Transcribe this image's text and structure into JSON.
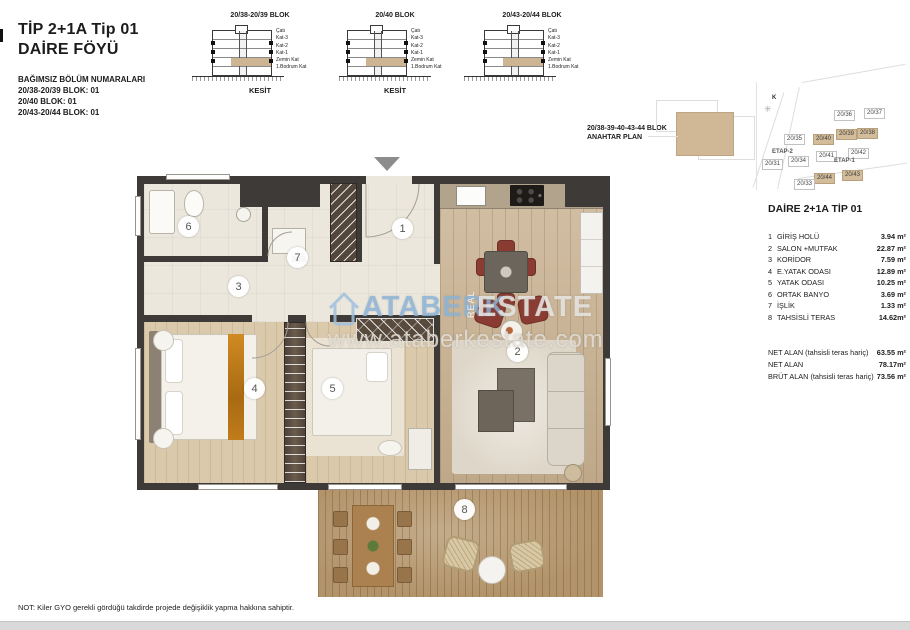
{
  "header": {
    "title_line1": "TİP 2+1A Tip 01",
    "title_line2": "DAİRE FÖYÜ",
    "subtitle": "BAĞIMSIZ BÖLÜM NUMARALARI",
    "block_lines": {
      "0": "20/38-20/39 BLOK: 01",
      "1": "20/40 BLOK: 01",
      "2": "20/43-20/44 BLOK: 01"
    }
  },
  "sections": {
    "floor_labels": {
      "0": "Çatı",
      "1": "Kat-3",
      "2": "Kat-2",
      "3": "Kat-1",
      "4": "Zemin Kat",
      "5": "1.Bodrum Kat"
    },
    "items": {
      "0": {
        "block": "20/38-20/39 BLOK",
        "caption": "KESİT"
      },
      "1": {
        "block": "20/40 BLOK",
        "caption": "KESİT"
      },
      "2": {
        "block": "20/43-20/44 BLOK",
        "caption": ""
      }
    }
  },
  "key_plan": {
    "line1": "20/38-39-40-43-44 BLOK",
    "line2": "ANAHTAR PLAN"
  },
  "site_plan": {
    "compass": "K",
    "blocks": {
      "0": "20/36",
      "1": "20/37",
      "2": "20/35",
      "3": "20/40",
      "4": "20/39",
      "5": "20/38",
      "6": "ETAP-2",
      "7": "20/41",
      "8": "20/42",
      "9": "20/31",
      "10": "20/34",
      "11": "ETAP-1",
      "12": "20/44",
      "13": "20/43",
      "14": "20/33"
    }
  },
  "unit_panel": {
    "title": "DAİRE 2+1A TİP 01",
    "rooms": {
      "0": {
        "no": "1",
        "name": "GİRİŞ HOLÜ",
        "area": "3.94 m²"
      },
      "1": {
        "no": "2",
        "name": "SALON +MUTFAK",
        "area": "22.87 m²"
      },
      "2": {
        "no": "3",
        "name": "KORİDOR",
        "area": "7.59 m²"
      },
      "3": {
        "no": "4",
        "name": "E.YATAK ODASI",
        "area": "12.89 m²"
      },
      "4": {
        "no": "5",
        "name": "YATAK ODASI",
        "area": "10.25 m²"
      },
      "5": {
        "no": "6",
        "name": "ORTAK BANYO",
        "area": "3.69 m²"
      },
      "6": {
        "no": "7",
        "name": "İŞLİK",
        "area": "1.33 m²"
      },
      "7": {
        "no": "8",
        "name": "TAHSİSLİ TERAS",
        "area": "14.62m²"
      }
    },
    "totals": {
      "0": {
        "label": "NET ALAN (tahsisli teras hariç)",
        "value": "63.55 m²"
      },
      "1": {
        "label": "NET ALAN",
        "value": "78.17m²"
      },
      "2": {
        "label": "BRÜT ALAN (tahsisli teras hariç)",
        "value": "73.56 m²"
      }
    }
  },
  "plan": {
    "watermark": {
      "brand_left": "ATABERK",
      "brand_mid": "REAL",
      "brand_right": "ESTATE",
      "url": "www.ataberkestate.com",
      "brand_left_color": "#8fb4d6",
      "brand_right_color": "#e9e8e4"
    },
    "colors": {
      "wall": "#3e3a37",
      "hall_floor": "#ece7dc",
      "wood_floor": "#c9b190",
      "bedroom_floor": "#dbc9ab",
      "terrace_deck": "#b3946a",
      "accent_chair": "#8a3c33"
    }
  },
  "footer": {
    "note": "NOT: Kiler GYO gerekli gördüğü takdirde projede değişiklik yapma hakkına sahiptir."
  }
}
